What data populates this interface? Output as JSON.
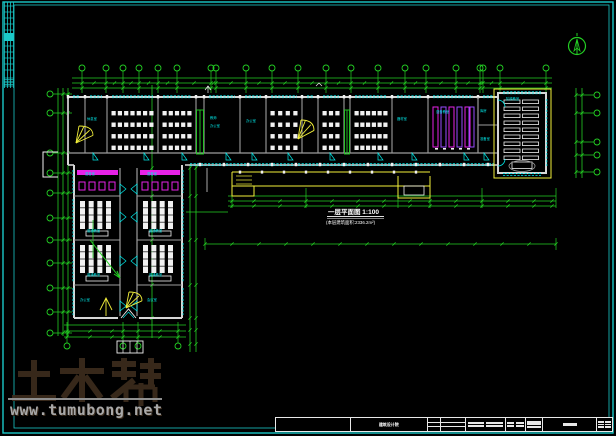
{
  "canvas": {
    "w": 616,
    "h": 436,
    "bg": "#000000"
  },
  "colors": {
    "frame": "#1bc9c9",
    "green": "#23cf23",
    "cyan": "#00e8e8",
    "yellow": "#f2ef3a",
    "magenta": "#e822e8",
    "purple": "#9a4dff",
    "white": "#f0f0f0",
    "wall": "#d6d6d6",
    "wall_light": "#9d9d9d",
    "brown": "#3a2b1c",
    "grey": "#a8a8a8"
  },
  "watermark": {
    "logo": "土木帮",
    "url": "www.tumubong.net"
  },
  "plan_title": {
    "text": "一层平面图 1:100",
    "subtitle": "(本层建筑面积:2336.2m²)"
  },
  "north_arrow": {
    "label": "北"
  },
  "axes": {
    "top": {
      "bubbles_x": [
        82,
        106,
        123,
        139,
        158,
        177,
        211,
        216,
        246,
        272,
        298,
        326,
        351,
        378,
        405,
        426,
        456,
        480,
        483,
        500,
        546
      ],
      "lines_y": [
        78,
        83,
        88
      ],
      "bubble_y": 68,
      "x1": 72,
      "x2": 552
    },
    "left": {
      "bubbles_y": [
        94,
        113,
        153,
        173,
        193,
        218,
        240,
        263,
        288,
        312,
        333
      ],
      "lines_x": [
        58,
        63,
        68
      ],
      "bubble_x": 50,
      "y1": 88,
      "y2": 336,
      "inner_x": 152
    },
    "right": {
      "bubbles_y": [
        95,
        113,
        142,
        155,
        172
      ],
      "lines_x": [
        576,
        582
      ],
      "bubble_x": 597,
      "y1": 88,
      "y2": 178
    },
    "wing_east": {
      "lines_x": [
        190,
        196
      ],
      "y1": 164,
      "y2": 352
    },
    "bottom_center": {
      "lines_y": [
        196,
        201,
        206
      ],
      "x1": 228,
      "x2": 556,
      "ticks_x": [
        232,
        254,
        280,
        306,
        332,
        358,
        384,
        410,
        430,
        456,
        482,
        508,
        534,
        552
      ],
      "line2_y": 244,
      "line2_x1": 205,
      "line2_x2": 556
    },
    "bottom_left": {
      "lines_y": [
        325,
        331,
        337
      ],
      "x1": 64,
      "x2": 186,
      "bubbles_x": [
        67,
        123,
        138,
        178
      ],
      "bubble_y": 346
    }
  },
  "top_wing": {
    "x1": 68,
    "x2": 498,
    "top": 97,
    "room_bottom": 153,
    "corridor_bottom": 165,
    "rooms": [
      {
        "x": 68,
        "w": 17,
        "type": "stair"
      },
      {
        "x": 85,
        "w": 22,
        "type": "office"
      },
      {
        "x": 107,
        "w": 51,
        "type": "desks"
      },
      {
        "x": 158,
        "w": 38,
        "type": "desks"
      },
      {
        "x": 196,
        "w": 8,
        "type": "greenstair"
      },
      {
        "x": 204,
        "w": 36,
        "type": "office"
      },
      {
        "x": 240,
        "w": 26,
        "type": "office"
      },
      {
        "x": 266,
        "w": 36,
        "type": "desks"
      },
      {
        "x": 302,
        "w": 16,
        "type": "stair"
      },
      {
        "x": 318,
        "w": 26,
        "type": "desks"
      },
      {
        "x": 344,
        "w": 6,
        "type": "greenstair"
      },
      {
        "x": 350,
        "w": 42,
        "type": "desks"
      },
      {
        "x": 392,
        "w": 34,
        "type": "office"
      },
      {
        "x": 428,
        "w": 50,
        "type": "lab"
      },
      {
        "x": 478,
        "w": 20,
        "type": "storage"
      }
    ]
  },
  "left_wing": {
    "west_x": 74,
    "east_x": 182,
    "corr_x1": 120,
    "corr_x2": 137,
    "top": 165,
    "bottom": 318,
    "row_y": [
      168,
      196,
      240,
      285
    ],
    "rows": [
      {
        "type": "lab"
      },
      {
        "type": "desks"
      },
      {
        "type": "desks"
      },
      {
        "type": "office"
      }
    ]
  },
  "hall": {
    "x1": 498,
    "x2": 546,
    "y1": 93,
    "y2": 173,
    "rows": 9,
    "label": "阶梯教室"
  },
  "labels": [
    {
      "x": 87,
      "y": 120,
      "t": "休息室"
    },
    {
      "x": 210,
      "y": 119,
      "t": "教师"
    },
    {
      "x": 210,
      "y": 127,
      "t": "办公室"
    },
    {
      "x": 246,
      "y": 122,
      "t": "办公室"
    },
    {
      "x": 397,
      "y": 120,
      "t": "器材室"
    },
    {
      "x": 436,
      "y": 113,
      "t": "语音教室"
    },
    {
      "x": 480,
      "y": 112,
      "t": "库房"
    },
    {
      "x": 480,
      "y": 140,
      "t": "准备室"
    },
    {
      "x": 506,
      "y": 100,
      "t": "阶梯教室"
    },
    {
      "x": 85,
      "y": 175,
      "t": "语音室"
    },
    {
      "x": 147,
      "y": 175,
      "t": "语音室"
    },
    {
      "x": 87,
      "y": 232,
      "t": "普通教室"
    },
    {
      "x": 149,
      "y": 232,
      "t": "普通教室"
    },
    {
      "x": 87,
      "y": 276,
      "t": "普通教室"
    },
    {
      "x": 149,
      "y": 276,
      "t": "普通教室"
    },
    {
      "x": 80,
      "y": 301,
      "t": "办公室"
    },
    {
      "x": 147,
      "y": 301,
      "t": "会议室"
    }
  ],
  "title_block": {
    "x": 275,
    "y": 417,
    "w": 338,
    "h": 15,
    "cells": [
      {
        "w": 75,
        "type": "blank",
        "text": ""
      },
      {
        "w": 78,
        "type": "text",
        "text": "建筑设计院"
      },
      {
        "w": 13,
        "type": "rows3",
        "text": ""
      },
      {
        "w": 25,
        "type": "rows3",
        "text": ""
      },
      {
        "w": 40,
        "type": "rows2text",
        "text": "审核 设计"
      },
      {
        "w": 20,
        "type": "dense",
        "text": "工程"
      },
      {
        "w": 18,
        "type": "logобars",
        "text": ""
      },
      {
        "w": 54,
        "type": "titledash",
        "text": "一层平面图"
      },
      {
        "w": 15,
        "type": "minigrid",
        "text": ""
      }
    ]
  }
}
